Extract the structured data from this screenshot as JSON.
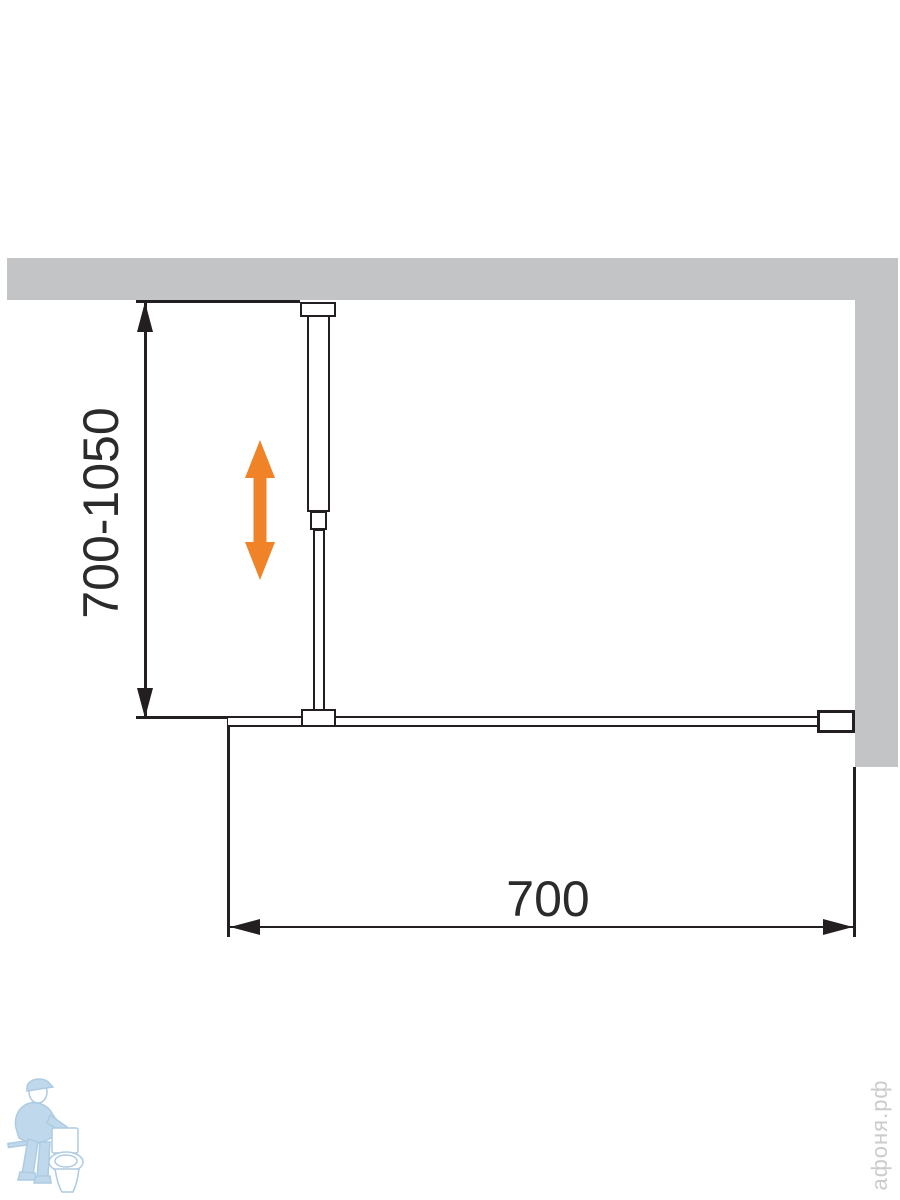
{
  "diagram": {
    "type": "shower-walk-in-panel-installation-drawing",
    "dimensions": {
      "height_range_label": "700-1050",
      "width_label": "700"
    },
    "parts": {
      "back_wall": "gray wall band (top)",
      "side_wall": "gray wall band (right)",
      "support_bar": "telescopic ceiling support bar",
      "glass_panel": "fixed glass panel (plan view)",
      "wall_bracket": "wall mounting bracket",
      "adjust_arrow": "orange double-headed vertical arrow (height adjustment)"
    },
    "colors": {
      "wall_gray": "#C2C4C6",
      "line_black": "#231F20",
      "arrow_orange": "#F08227",
      "watermark_blue_fill": "#B9D4E9",
      "watermark_blue_stroke": "#A5C6DF",
      "watermark_text_gray": "#CBCBCB"
    },
    "icons": {
      "adjust_arrow_icon": "double-headed-vertical-arrow",
      "watermark_logo_icon": "plumber-with-toilet"
    },
    "watermark": {
      "site_text": "афоня.рф"
    }
  }
}
